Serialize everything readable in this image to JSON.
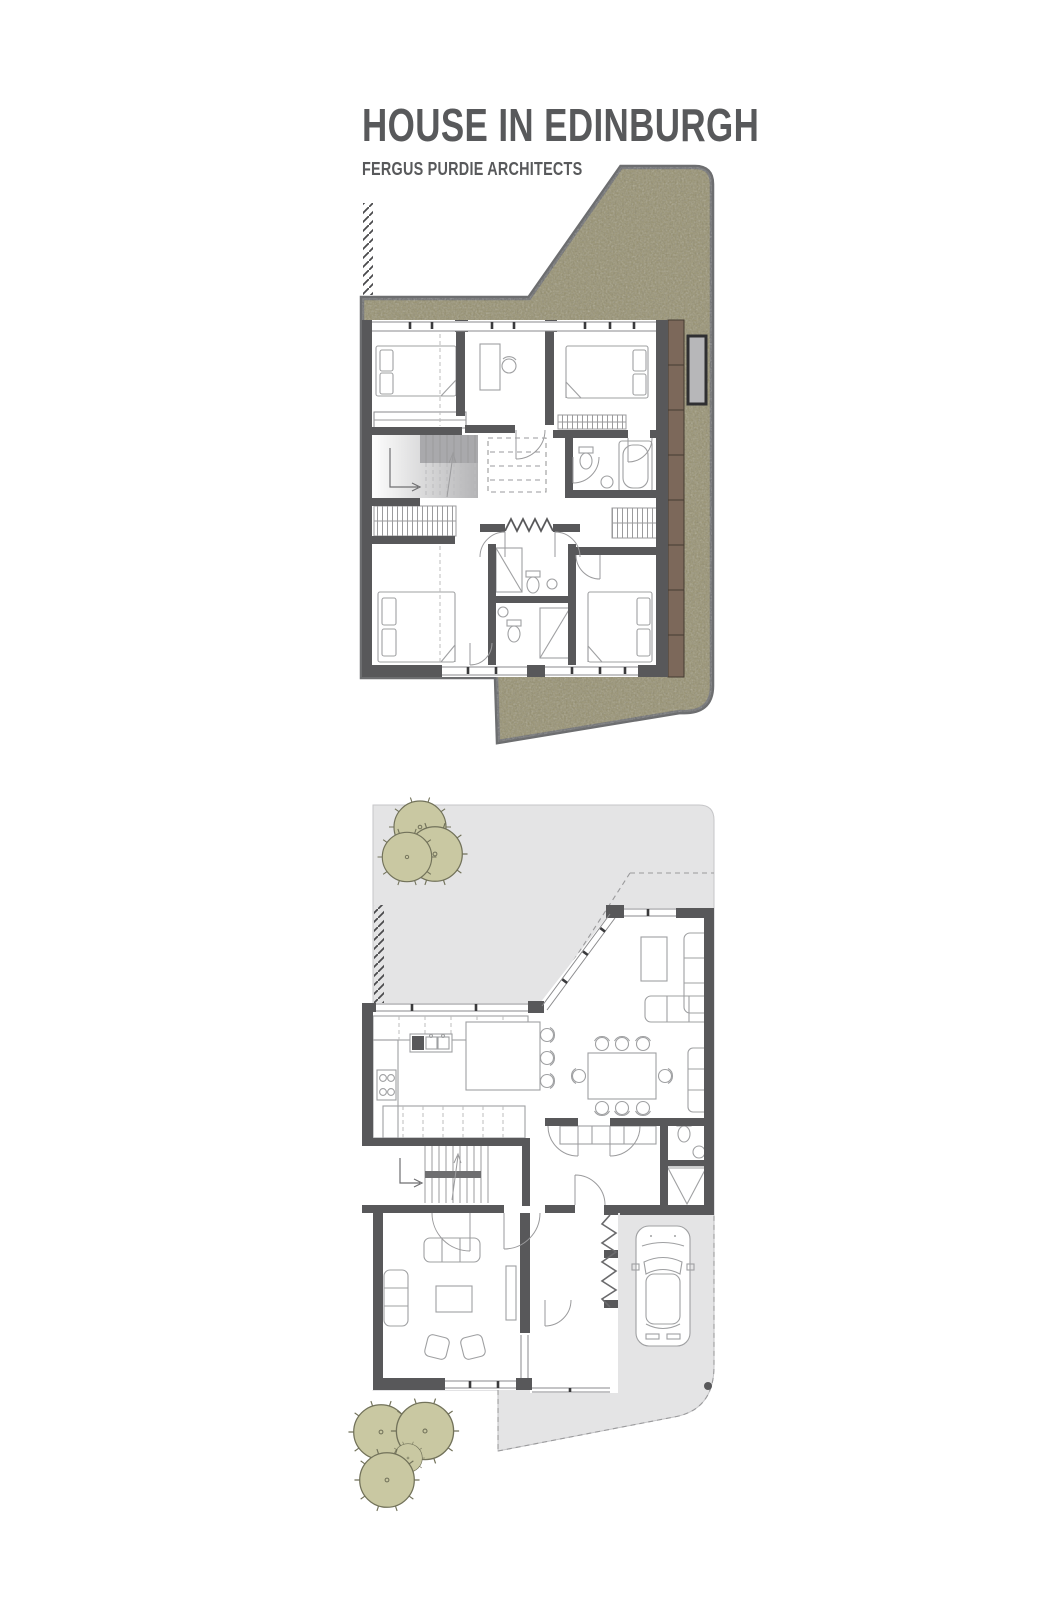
{
  "header": {
    "title": "HOUSE IN EDINBURGH",
    "subtitle": "FERGUS PURDIE ARCHITECTS",
    "text_color": "#58595b"
  },
  "palette": {
    "wall": "#58585a",
    "thin_line": "#8a8a8c",
    "furniture_line": "#9fa0a2",
    "green_roof": "#96906f",
    "site_border": "#6d6e70",
    "paving": "#e4e4e5",
    "deck": "#7c685a",
    "glass": "#b7b7b9",
    "tree_fill": "#c9c8a2",
    "tree_stroke": "#72725a"
  }
}
